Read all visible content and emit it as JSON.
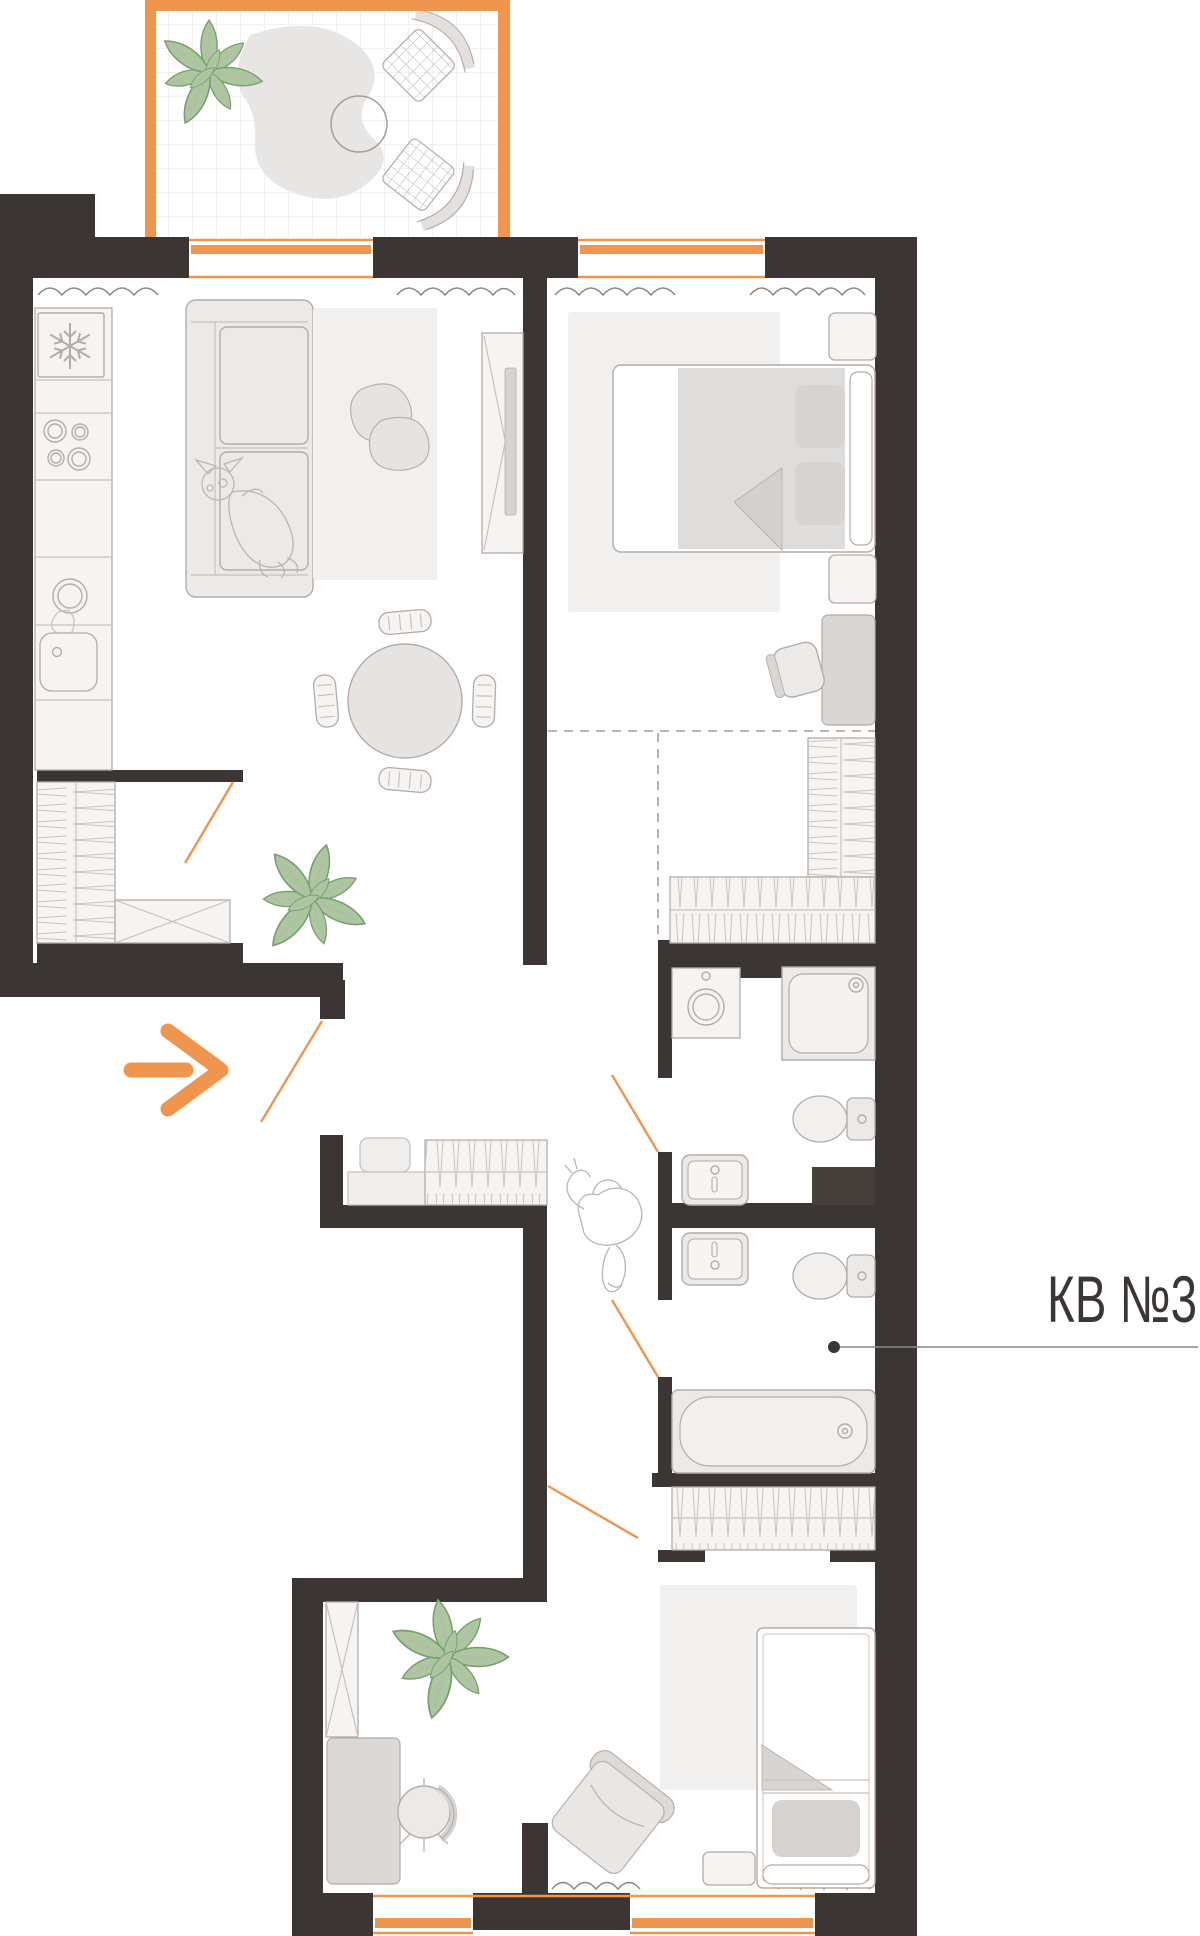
{
  "label": {
    "text": "КВ №3"
  },
  "icons": {
    "entrance_arrow": "arrow-right",
    "fridge_badge": "snowflake"
  },
  "colors": {
    "wall": "#3b3633",
    "accent": "#f0954e",
    "furniture_fill": "#eceae9",
    "furniture_stroke": "#b4aca7",
    "rug": "#f1f0ee",
    "soft_gray": "#d6d3d1",
    "plant_fill": "#a9c99d",
    "plant_stroke": "#7f9b76",
    "leader": "#8a8582",
    "text": "#3b3633"
  }
}
